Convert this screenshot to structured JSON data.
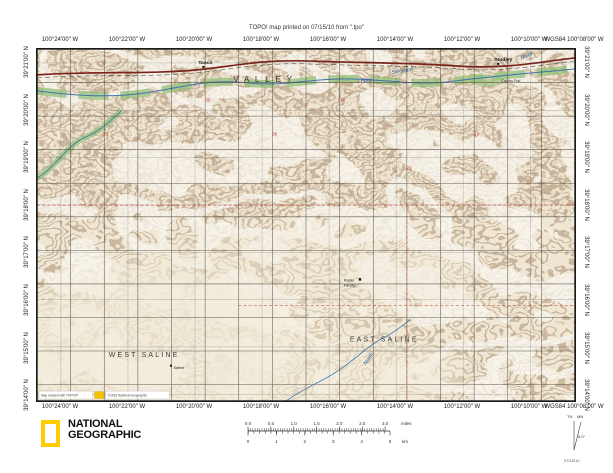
{
  "header": {
    "printed_line": "TOPO! map printed on 07/15/10 from \".tpo\""
  },
  "graticule": {
    "lon_labels": [
      "100°24'00\" W",
      "100°22'00\" W",
      "100°20'00\" W",
      "100°18'00\" W",
      "100°16'00\" W",
      "100°14'00\" W",
      "100°12'00\" W",
      "100°10'00\" W",
      "WGS84 100°08'00\" W"
    ],
    "lat_labels": [
      "39°21'00\" N",
      "39°20'00\" N",
      "39°19'00\" N",
      "39°18'00\" N",
      "39°17'00\" N",
      "39°16'00\" N",
      "39°15'00\" N",
      "39°14'00\" N"
    ]
  },
  "map": {
    "towns": {
      "tasco": "Tasco",
      "studley": "Studley"
    },
    "townships": {
      "valley": "VALLEY",
      "west_saline": "WEST SALINE",
      "east_saline": "EAST SALINE"
    },
    "water": {
      "fork": "Fork",
      "solomon": "Solomon",
      "river": "River",
      "north": "North"
    },
    "places": {
      "cactus_flat": "Cactus Flat",
      "radio_line1": "Radio",
      "radio_line2": "Facility",
      "salem": "Salem"
    },
    "sections": [
      "25",
      "30",
      "36",
      "14",
      "22",
      "10"
    ],
    "credits": {
      "created": "Map created with TOPO!®",
      "copyright": "©2010 National Geographic"
    }
  },
  "footer": {
    "logo": {
      "line1": "NATIONAL",
      "line2": "GEOGRAPHIC"
    },
    "scalebar": {
      "miles": [
        "0.0",
        "0.5",
        "1.0",
        "1.5",
        "2.0",
        "2.5",
        "3.0"
      ],
      "miles_unit": "miles",
      "km": [
        "0",
        "1",
        "2",
        "3",
        "4",
        "5"
      ],
      "km_unit": "km"
    },
    "declination": {
      "tn": "TN",
      "mn": "MN",
      "angle": "8.0°",
      "date": "07/15/10"
    }
  },
  "colors": {
    "paper": "#efe7d3",
    "contour": "#8b6b4a",
    "water": "#3f74ad",
    "vegetation": "#93c07a",
    "road": "#7b241c",
    "natgeo_yellow": "#ffcc00"
  }
}
